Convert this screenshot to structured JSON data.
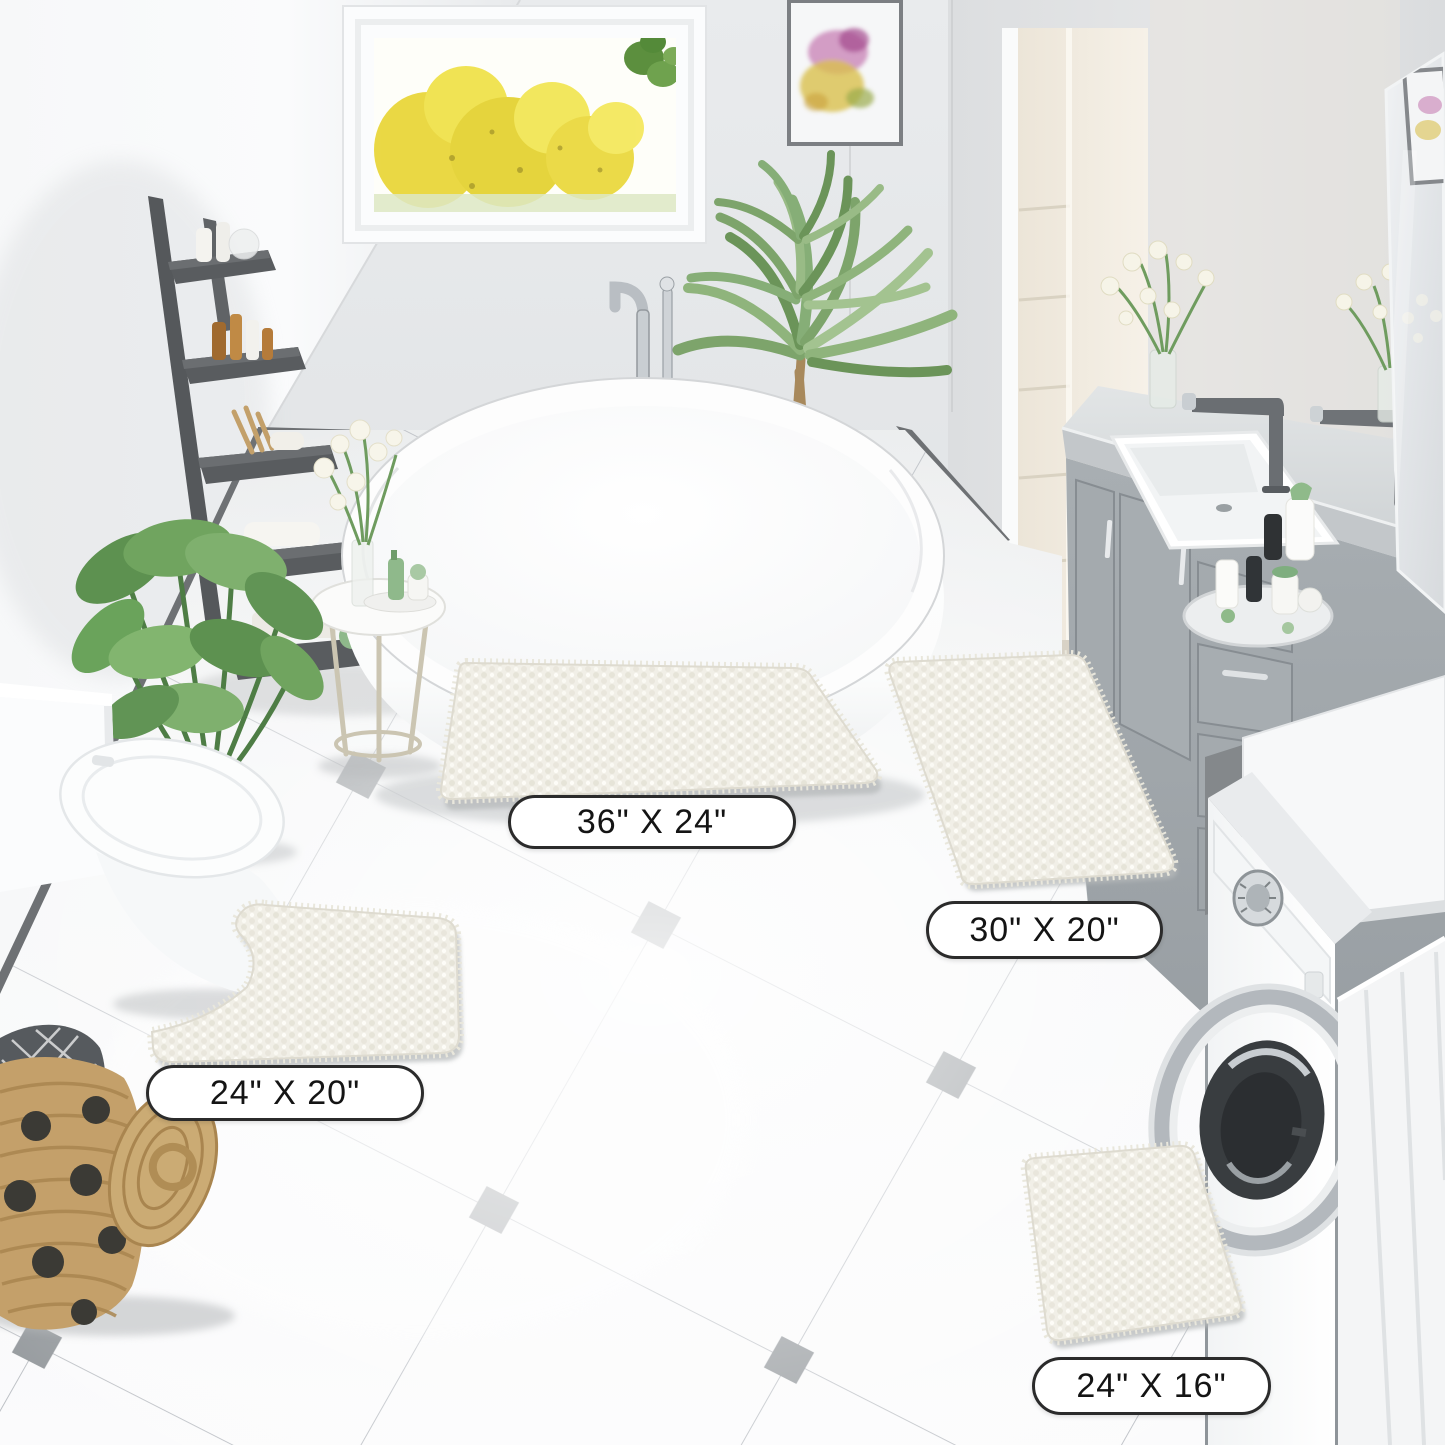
{
  "page": {
    "type": "product lifestyle photo",
    "scene": "bathroom with chenille bath rug set in four sizes"
  },
  "size_labels": [
    {
      "id": "mat-36x24",
      "text": "36\" X 24\""
    },
    {
      "id": "mat-30x20",
      "text": "30\" X 20\""
    },
    {
      "id": "mat-24x20",
      "text": "24\" X 20\""
    },
    {
      "id": "mat-24x16",
      "text": "24\" X 16\""
    }
  ],
  "mats": [
    {
      "size": "36\" X 24\"",
      "shape": "rectangle",
      "color": "ivory white"
    },
    {
      "size": "30\" X 20\"",
      "shape": "rectangle",
      "color": "ivory white"
    },
    {
      "size": "24\" X 20\"",
      "shape": "U-shape contour",
      "color": "ivory white"
    },
    {
      "size": "24\" X 16\"",
      "shape": "rectangle",
      "color": "ivory white"
    }
  ],
  "colors": {
    "mat": "#f1efe7",
    "floor_tile": "#f7f8f9",
    "tile_accent": "#8d9296",
    "grout": "#b6bac0",
    "wall": "#e6e8ea",
    "baseboard": "#6e7174",
    "vanity_cabinet": "#9fa5a9",
    "basket": "#c4a06a",
    "window_foliage": "#e9d63b",
    "label_bg": "#ffffff",
    "label_border": "#2b2b2b"
  },
  "scene_objects": [
    "window with yellow autumn trees",
    "framed watercolor artwork",
    "dark gray ladder shelf with toiletries",
    "freestanding white bathtub",
    "chrome floor-mounted tub faucet",
    "potted palm plant",
    "monstera floor plant",
    "round side table with flower vase",
    "white toilet",
    "wicker basket with polka dots and towel",
    "gray vanity with white sink and dark faucets",
    "wall mirror",
    "front-load washing machine",
    "diagonal white tile floor with gray diamond accents"
  ]
}
